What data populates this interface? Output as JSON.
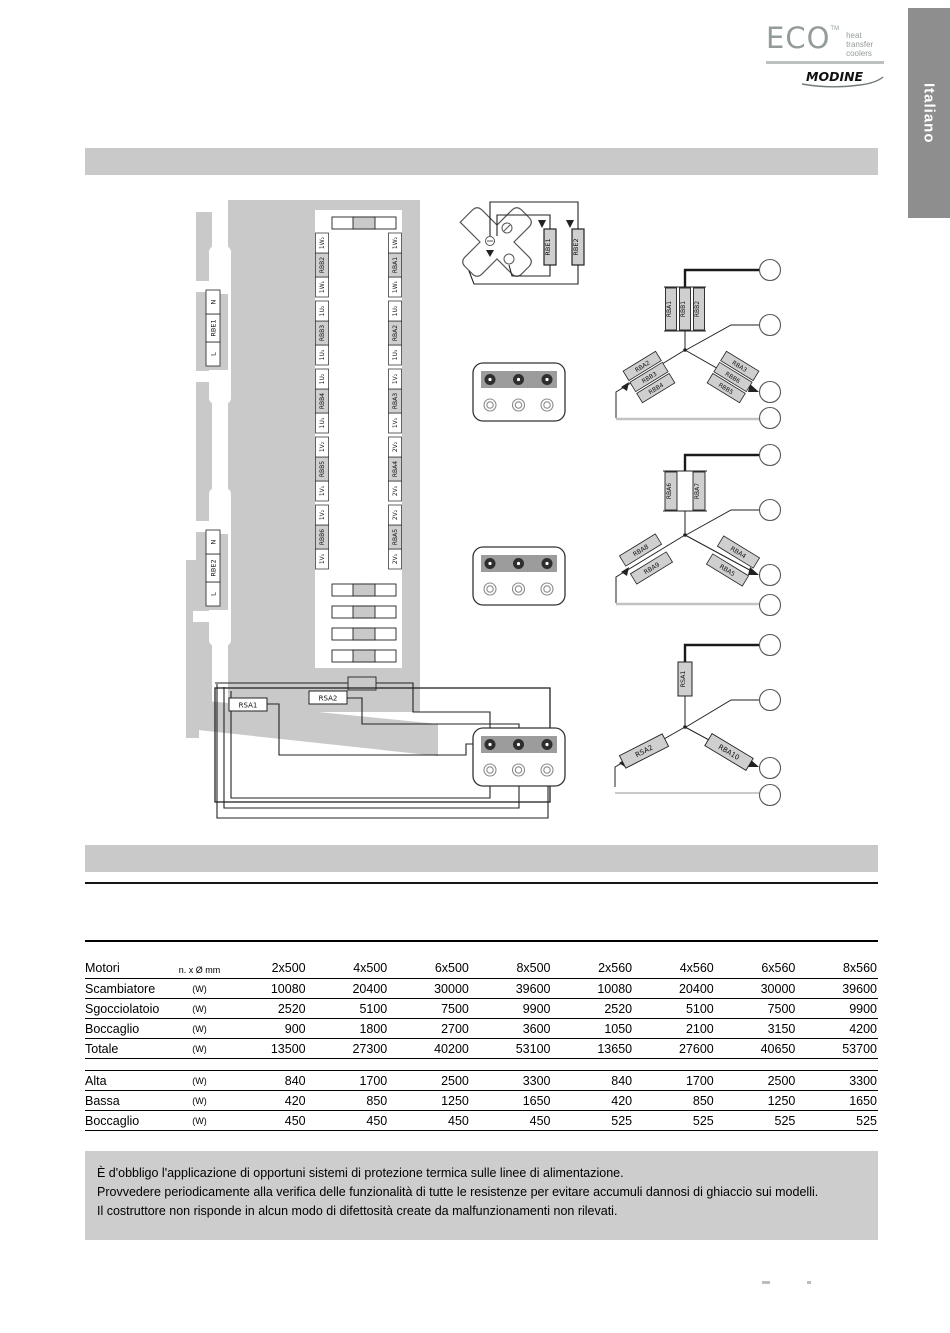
{
  "logo": {
    "eco": "ECO",
    "tm": "TM",
    "tagline_line1": "heat transfer",
    "tagline_line2": "coolers",
    "modine": "MODINE"
  },
  "language_tab": {
    "label": "Italiano"
  },
  "diagram": {
    "power_labels": [
      {
        "top": "N",
        "name": "RBE1",
        "bottom": "L"
      },
      {
        "top": "N",
        "name": "RBE2",
        "bottom": "L"
      }
    ],
    "heater_resistors": [
      "RBE1",
      "RBE2"
    ],
    "unit_left_terminals": [
      {
        "top": "1W₂",
        "name": "RBB2",
        "bottom": "1W₁"
      },
      {
        "top": "1U₂",
        "name": "RBB3",
        "bottom": "1U₁"
      },
      {
        "top": "1U₂",
        "name": "RBB4",
        "bottom": "1U₁"
      },
      {
        "top": "1V₂",
        "name": "RBB5",
        "bottom": "1V₁"
      },
      {
        "top": "1V₂",
        "name": "RBB6",
        "bottom": "1V₁"
      }
    ],
    "unit_right_terminals": [
      {
        "top": "1W₂",
        "name": "RBA1",
        "bottom": "1W₁"
      },
      {
        "top": "1U₂",
        "name": "RBA2",
        "bottom": "1U₁"
      },
      {
        "top": "1V₂",
        "name": "RBA3",
        "bottom": "1V₁"
      },
      {
        "top": "2V₂",
        "name": "RBA4",
        "bottom": "2V₁"
      },
      {
        "top": "2V₂",
        "name": "RBA5",
        "bottom": "2V₁"
      }
    ],
    "star_groups": [
      {
        "top": [
          "RBA1",
          "RBB1",
          "RBB2"
        ],
        "left": [
          "RBA2",
          "RBB3",
          "RBB4"
        ],
        "right": [
          "RBA3",
          "RBB6",
          "RBB5"
        ]
      },
      {
        "top": [
          "RBA6",
          "RBA7"
        ],
        "left": [
          "RBA8",
          "RBA9"
        ],
        "right": [
          "RBA4",
          "RBA5"
        ]
      },
      {
        "top": [
          "RSA1"
        ],
        "left": [
          "RSA2"
        ],
        "right": [
          "RBA10"
        ]
      }
    ],
    "drip_tray_resistors": [
      "RSA1",
      "RSA2"
    ]
  },
  "power_table": {
    "header": {
      "label": "Motori",
      "unit": "n. x Ø mm",
      "models": [
        "2x500",
        "4x500",
        "6x500",
        "8x500",
        "2x560",
        "4x560",
        "6x560",
        "8x560"
      ]
    },
    "rows": [
      {
        "label": "Scambiatore",
        "unit": "(W)",
        "values": [
          "10080",
          "20400",
          "30000",
          "39600",
          "10080",
          "20400",
          "30000",
          "39600"
        ]
      },
      {
        "label": "Sgocciolatoio",
        "unit": "(W)",
        "values": [
          "2520",
          "5100",
          "7500",
          "9900",
          "2520",
          "5100",
          "7500",
          "9900"
        ]
      },
      {
        "label": "Boccaglio",
        "unit": "(W)",
        "values": [
          "900",
          "1800",
          "2700",
          "3600",
          "1050",
          "2100",
          "3150",
          "4200"
        ]
      },
      {
        "label": "Totale",
        "unit": "(W)",
        "values": [
          "13500",
          "27300",
          "40200",
          "53100",
          "13650",
          "27600",
          "40650",
          "53700"
        ]
      }
    ]
  },
  "speed_table": {
    "rows": [
      {
        "label": "Alta",
        "unit": "(W)",
        "values": [
          "840",
          "1700",
          "2500",
          "3300",
          "840",
          "1700",
          "2500",
          "3300"
        ]
      },
      {
        "label": "Bassa",
        "unit": "(W)",
        "values": [
          "420",
          "850",
          "1250",
          "1650",
          "420",
          "850",
          "1250",
          "1650"
        ]
      },
      {
        "label": "Boccaglio",
        "unit": "(W)",
        "values": [
          "450",
          "450",
          "450",
          "450",
          "525",
          "525",
          "525",
          "525"
        ]
      }
    ]
  },
  "note": {
    "lines": [
      "È d'obbligo l'applicazione di opportuni sistemi di protezione termica sulle linee di alimentazione.",
      "Provvedere periodicamente alla verifica delle funzionalità di tutte le resistenze per evitare accumuli dannosi di ghiaccio sui modelli.",
      "Il costruttore non risponde in alcun modo di difettosità create da malfunzionamenti non rilevati."
    ]
  },
  "colors": {
    "body_gray": "#c9c9c9",
    "tab_gray": "#8e8e8e",
    "note_gray": "#cdcdcd",
    "logo_gray": "#939b9b",
    "wire_light": "#c3c3c3",
    "line_dark": "#1a1a1a"
  }
}
